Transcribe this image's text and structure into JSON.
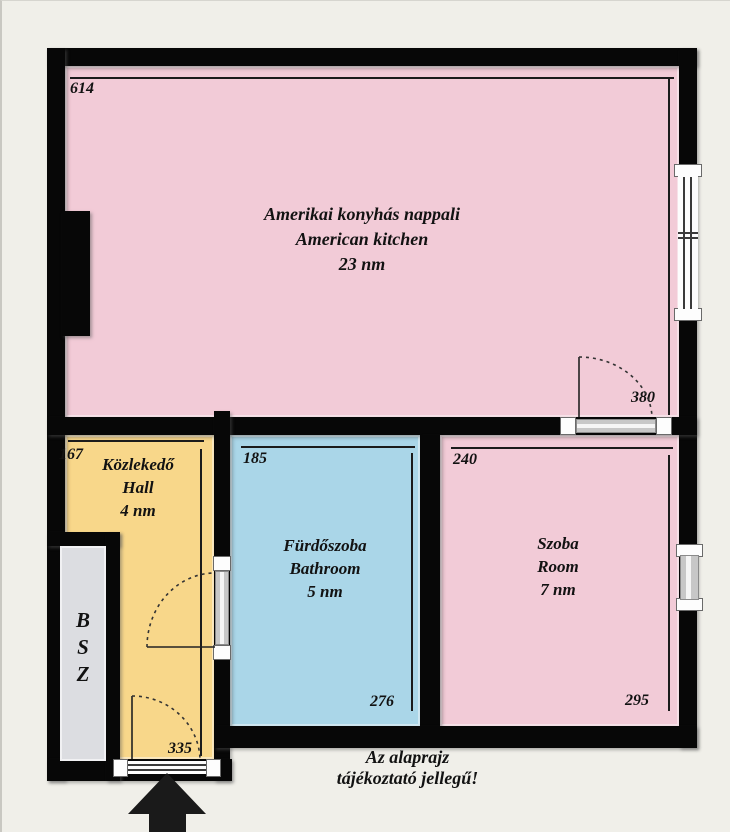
{
  "rooms": {
    "living": {
      "name_hu": "Amerikai konyhás nappali",
      "name_en": "American kitchen",
      "area": "23 nm",
      "width_cm": "614",
      "depth_cm": "380"
    },
    "hall": {
      "name_hu": "Közlekedő",
      "name_en": "Hall",
      "area": "4 nm",
      "width_cm": "167",
      "depth_cm": "335"
    },
    "bathroom": {
      "name_hu": "Fürdőszoba",
      "name_en": "Bathroom",
      "area": "5 nm",
      "width_cm": "185",
      "depth_cm": "276"
    },
    "bedroom": {
      "name_hu": "Szoba",
      "name_en": "Room",
      "area": "7 nm",
      "width_cm": "240",
      "depth_cm": "295"
    }
  },
  "closet": {
    "letters": [
      "B",
      "S",
      "Z"
    ]
  },
  "disclaimer": {
    "line1": "Az alaprajz",
    "line2": "tájékoztató jellegű!"
  },
  "colors": {
    "living": "#f2cbd7",
    "hall": "#f8d78a",
    "bathroom": "#aad6e8",
    "bedroom": "#f2cbd7",
    "closet": "#dcdde1",
    "wall": "#070707",
    "background": "#f0efe9"
  }
}
